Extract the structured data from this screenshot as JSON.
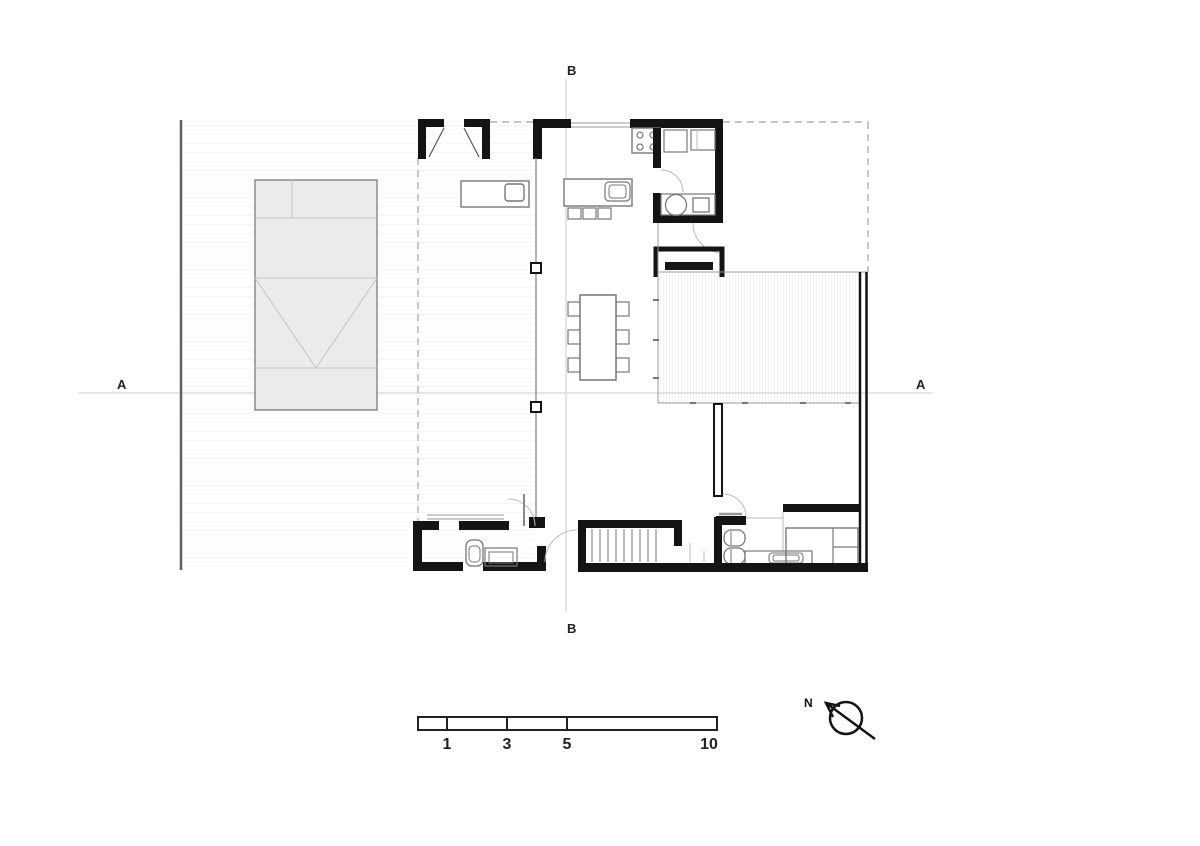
{
  "drawing": {
    "section_markers": {
      "a_left": "A",
      "a_right": "A",
      "b_top": "B",
      "b_bottom": "B"
    },
    "north_arrow": {
      "label": "N"
    },
    "scale_bar": {
      "ticks": [
        "1",
        "3",
        "5",
        "10"
      ]
    },
    "colors": {
      "wall": "#141414",
      "furniture_line": "#777777",
      "dashed_overhang": "#b0b0b0",
      "carport_fill": "#ebebeb",
      "section_line": "#e5e5e5",
      "background": "#ffffff"
    }
  }
}
